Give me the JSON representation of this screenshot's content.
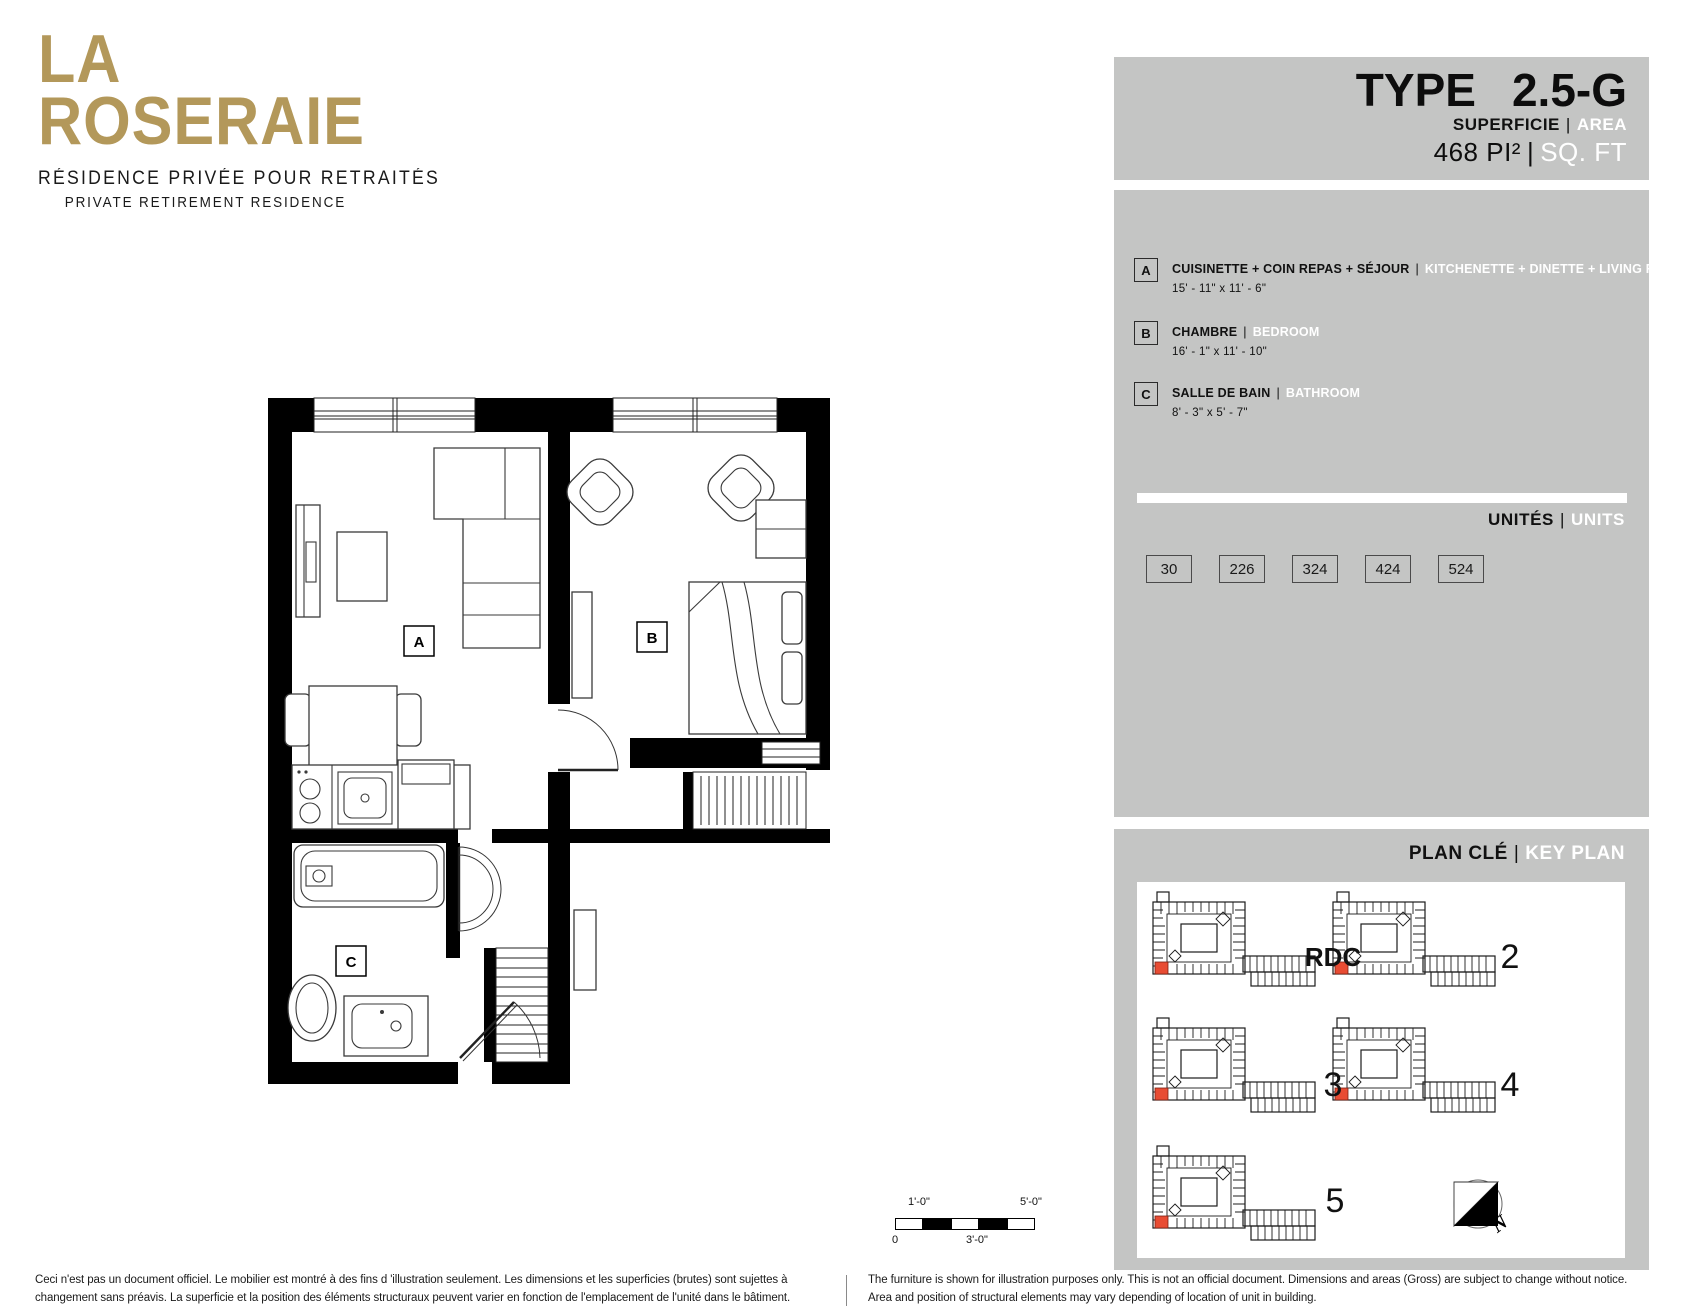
{
  "sep": "|",
  "brand": {
    "line1": "LA",
    "line2": "ROSERAIE",
    "tagline_fr": "RÉSIDENCE PRIVÉE POUR RETRAITÉS",
    "tagline_en": "PRIVATE RETIREMENT RESIDENCE",
    "gold": "#b3985a"
  },
  "type_box": {
    "label": "TYPE",
    "value": "2.5-G",
    "area_fr": "SUPERFICIE",
    "area_en": "AREA",
    "value_fr": "468 PI²",
    "value_en": "SQ. FT"
  },
  "legend": {
    "rooms": [
      {
        "letter": "A",
        "name_fr": "CUISINETTE + COIN REPAS + SÉJOUR",
        "name_en": "KITCHENETTE + DINETTE + LIVING ROOM",
        "dimensions": "15' - 11\" x 11' - 6\""
      },
      {
        "letter": "B",
        "name_fr": "CHAMBRE",
        "name_en": "BEDROOM",
        "dimensions": "16' - 1\" x 11' - 10\""
      },
      {
        "letter": "C",
        "name_fr": "SALLE DE BAIN",
        "name_en": "BATHROOM",
        "dimensions": "8' - 3\" x 5' - 7\""
      }
    ]
  },
  "units": {
    "label_fr": "UNITÉS",
    "label_en": "UNITS",
    "numbers": [
      "30",
      "226",
      "324",
      "424",
      "524"
    ]
  },
  "key_plan": {
    "label_fr": "PLAN CLÉ",
    "label_en": "KEY PLAN",
    "floors": [
      "RDC",
      "2",
      "3",
      "4",
      "5"
    ],
    "north": "N",
    "highlight_color": "#e84c33"
  },
  "floor_plan": {
    "labels": {
      "a": "A",
      "b": "B",
      "c": "C"
    }
  },
  "scale_bar": {
    "t1": "1'-0\"",
    "t2": "5'-0\"",
    "b1": "0",
    "b2": "3'-0\""
  },
  "footer": {
    "fr1": "Ceci n'est pas un document officiel.  Le mobilier est montré à des fins d 'illustration seulement.  Les dimensions et les superficies (brutes) sont sujettes à",
    "fr2": "changement sans préavis. La superficie et la position des éléments structuraux peuvent varier en fonction de l'emplacement de l'unité dans le bâtiment.",
    "en1": "The furniture is shown for illustration purposes only.  This is not an official document.  Dimensions and areas (Gross) are subject to change without notice.",
    "en2": "Area and position of structural elements may vary depending of location of unit in building."
  },
  "colors": {
    "panel_gray": "#c4c5c4",
    "wall_black": "#000000",
    "white": "#ffffff"
  }
}
